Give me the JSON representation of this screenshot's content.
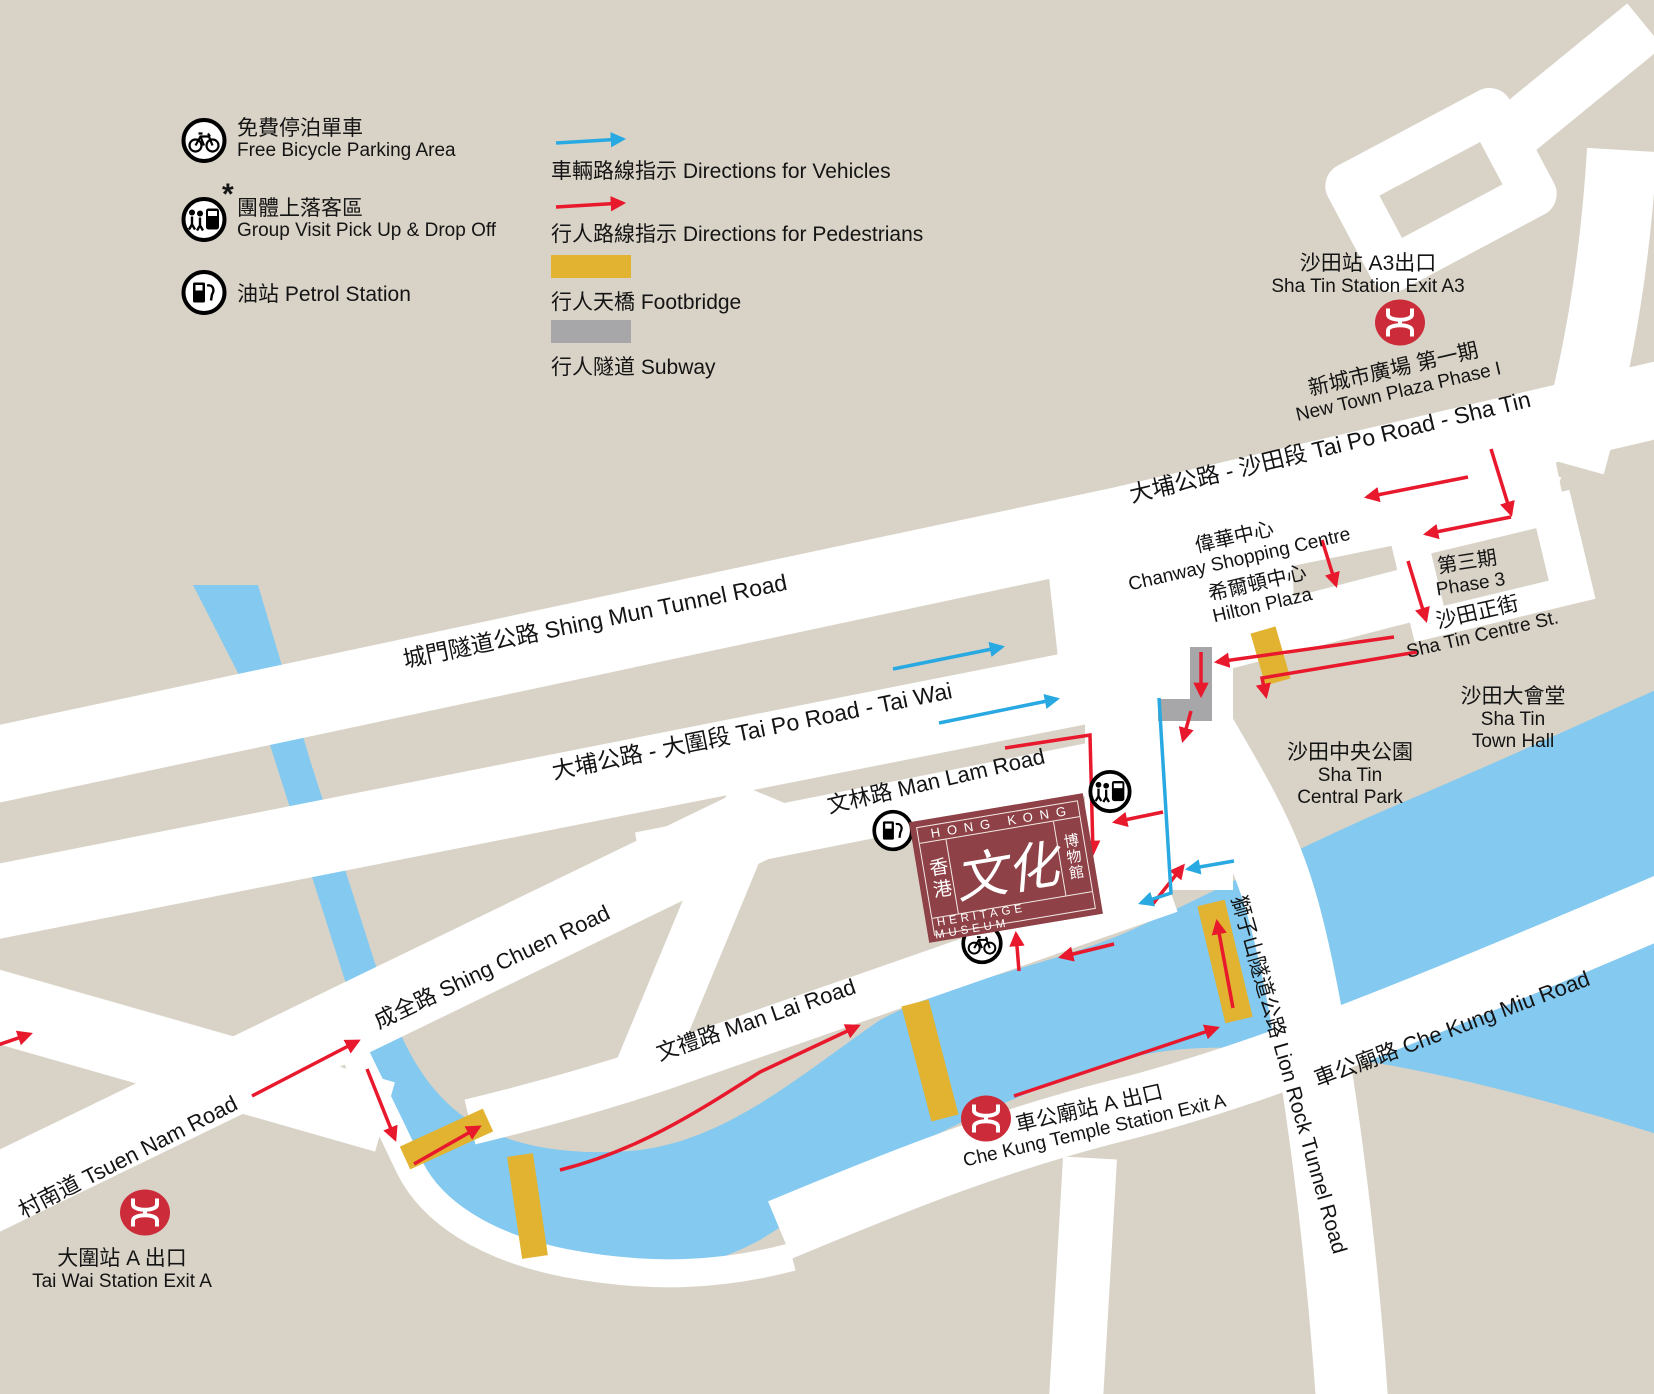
{
  "colors": {
    "background": "#D9D3C7",
    "road": "#FFFFFF",
    "river": "#84C9EF",
    "footbridge": "#E1B330",
    "subway": "#A7A7A9",
    "pedestrian_route": "#E8192C",
    "vehicle_route": "#29A9E1",
    "mtr_red": "#CC2C39",
    "museum_maroon": "#8E4247",
    "text": "#141414"
  },
  "legend": {
    "bicycle_zh": "免費停泊單車",
    "bicycle_en": "Free Bicycle Parking Area",
    "group_zh": "團體上落客區",
    "group_en": "Group Visit Pick Up & Drop Off",
    "group_asterisk": "*",
    "petrol": "油站 Petrol Station",
    "vehicles": "車輛路線指示 Directions for Vehicles",
    "pedestrians": "行人路線指示 Directions for Pedestrians",
    "footbridge": "行人天橋 Footbridge",
    "subway": "行人隧道 Subway"
  },
  "roads": {
    "shing_mun": "城門隧道公路 Shing Mun Tunnel Road",
    "tai_po_sha_tin": "大埔公路 - 沙田段 Tai Po Road - Sha Tin",
    "tai_po_tai_wai": "大埔公路 - 大圍段 Tai Po Road - Tai Wai",
    "man_lam": "文林路 Man Lam Road",
    "man_lai": "文禮路 Man Lai Road",
    "shing_chuen": "成全路 Shing Chuen Road",
    "tsuen_nam": "村南道 Tsuen Nam Road",
    "che_kung_miu": "車公廟路 Che Kung Miu Road",
    "lion_rock": "獅子山隧道公路 Lion Rock Tunnel Road",
    "sha_tin_centre_zh": "沙田正街",
    "sha_tin_centre_en": "Sha Tin Centre St."
  },
  "places": {
    "new_town_plaza_zh": "新城市廣場 第一期",
    "new_town_plaza_en": "New Town Plaza Phase I",
    "chanway_zh": "偉華中心",
    "chanway_en": "Chanway Shopping Centre",
    "hilton_zh": "希爾頓中心",
    "hilton_en": "Hilton Plaza",
    "phase3_zh": "第三期",
    "phase3_en": "Phase 3",
    "town_hall_zh": "沙田大會堂",
    "town_hall_en": "Sha Tin\nTown Hall",
    "central_park_zh": "沙田中央公園",
    "central_park_en": "Sha Tin\nCentral Park"
  },
  "stations": {
    "sha_tin_zh": "沙田站 A3出口",
    "sha_tin_en": "Sha Tin Station Exit A3",
    "che_kung_zh": "車公廟站 A 出口",
    "che_kung_en": "Che Kung Temple Station Exit A",
    "tai_wai_zh": "大圍站 A 出口",
    "tai_wai_en": "Tai Wai Station Exit A"
  },
  "museum": {
    "top": "HONG KONG",
    "left": "香港",
    "center": "文化",
    "right": "博物館",
    "bottom": "HERITAGE MUSEUM"
  }
}
